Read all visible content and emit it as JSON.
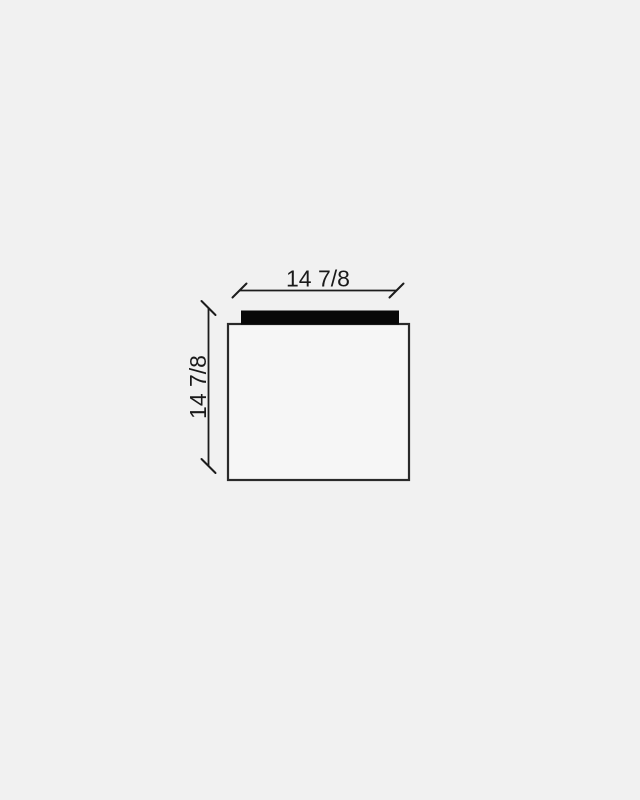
{
  "page": {
    "background_color": "#f1f1f1"
  },
  "drawing": {
    "colors": {
      "dimension_line": "#1c1c1c",
      "label_text": "#1a1a1a",
      "body_outline": "#2a2a2a",
      "body_fill": "#f6f6f6",
      "cap_fill": "#080808"
    },
    "dimensions": {
      "width": {
        "label": "14 7/8"
      },
      "height": {
        "label": "14 7/8"
      }
    }
  }
}
